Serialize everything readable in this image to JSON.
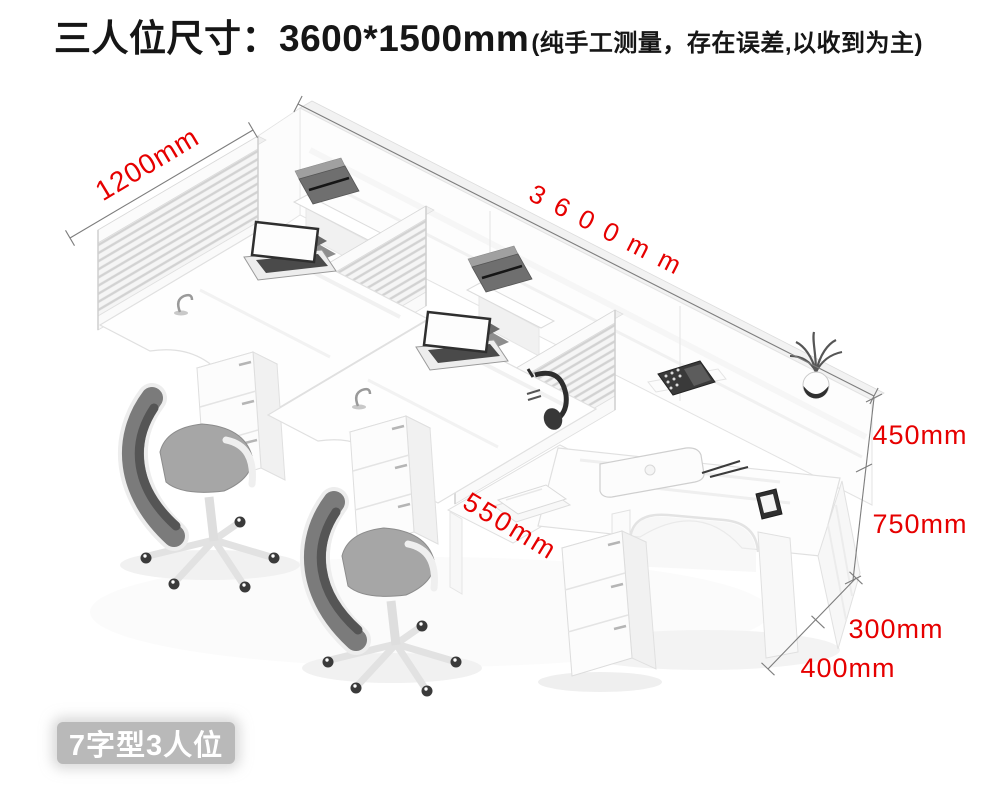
{
  "title": {
    "main": "三人位尺寸：3600*1500mm",
    "note": "(纯手工测量，存在误差,以收到为主)"
  },
  "dims": {
    "total_length": "3600mm",
    "wing_depth": "1200mm",
    "screen_above_desk": "450mm",
    "desk_height": "750mm",
    "return_desk_depth": "550mm",
    "end_panel_depth": "300mm",
    "end_cabinet_width": "400mm"
  },
  "badge": {
    "label": "7字型3人位"
  },
  "colors": {
    "dimension_label": "#e60000",
    "dimension_line": "#7d7d7d",
    "title_text": "#161616",
    "badge_background": "#b9b9b9",
    "badge_text": "#ffffff"
  }
}
